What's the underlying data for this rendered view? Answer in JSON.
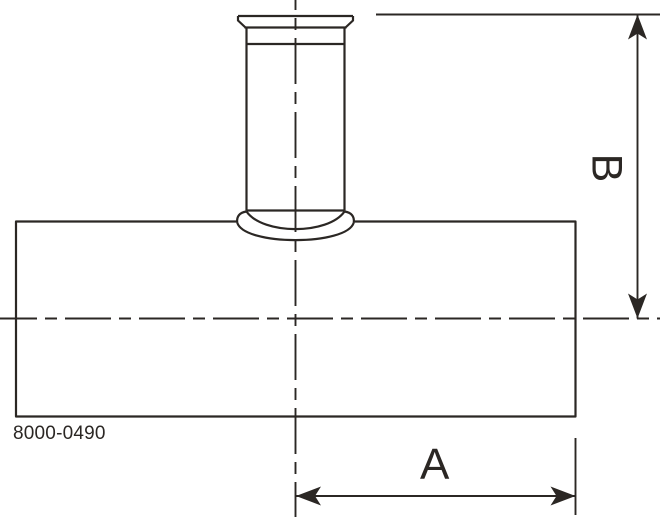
{
  "theme": {
    "line": "#2b2724",
    "background": "#ffffff"
  },
  "drawing": {
    "part_number": "8000-0490",
    "dimension_a_label": "A",
    "dimension_b_label": "B"
  }
}
